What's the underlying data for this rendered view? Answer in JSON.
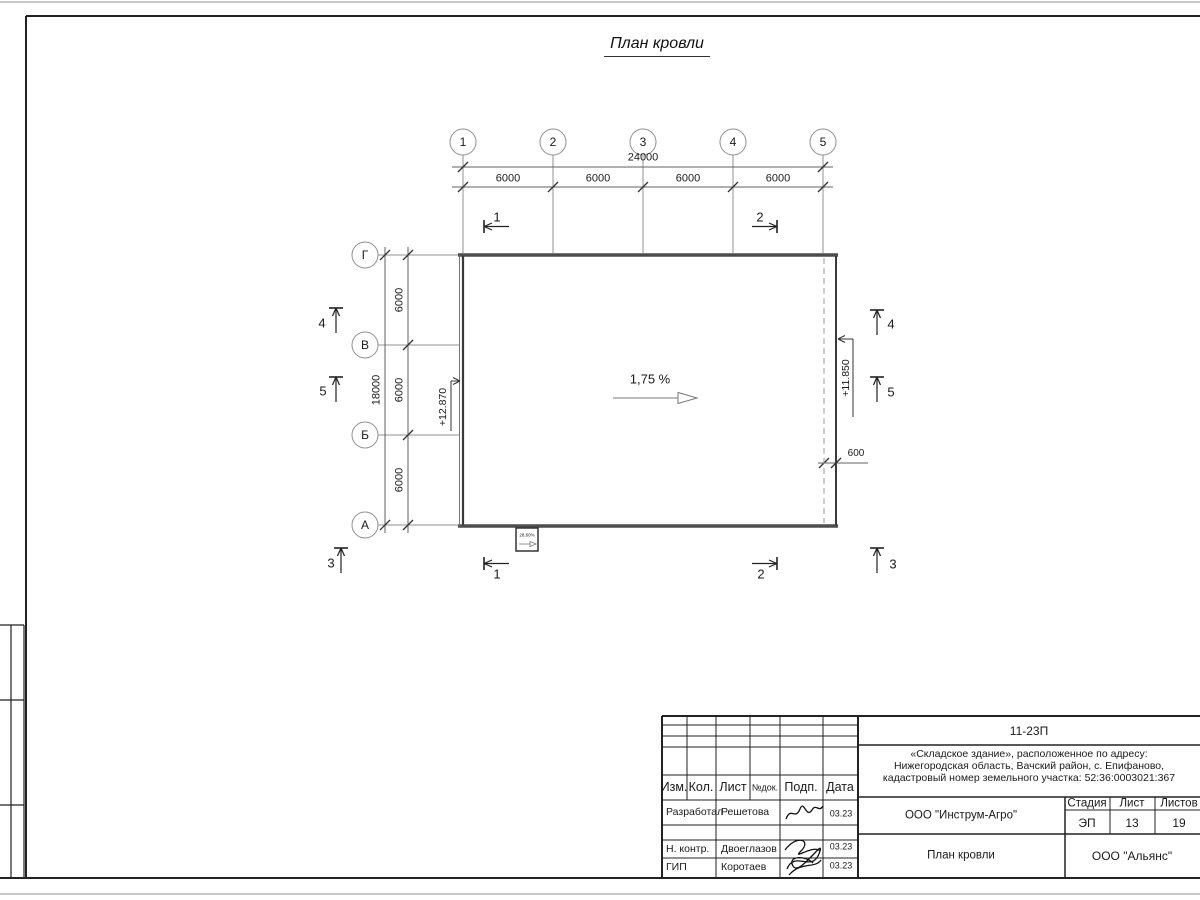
{
  "sheet": {
    "title": "План кровли"
  },
  "grid": {
    "top_axes": [
      "1",
      "2",
      "3",
      "4",
      "5"
    ],
    "left_axes": [
      "Г",
      "В",
      "Б",
      "А"
    ]
  },
  "dimensions": {
    "top_total": "24000",
    "top_segments": [
      "6000",
      "6000",
      "6000",
      "6000"
    ],
    "left_total": "18000",
    "left_segments": [
      "6000",
      "6000",
      "6000"
    ],
    "overhang": "600"
  },
  "annotations": {
    "slope": "1,75 %",
    "canopy_slope": "28,60%",
    "elevation_left": "+12.870",
    "elevation_right": "+11.850"
  },
  "section_marks": {
    "s1": "1",
    "s2": "2",
    "s3": "3",
    "s4": "4",
    "s5": "5"
  },
  "titleblock": {
    "code": "11-23П",
    "project_line1": "«Складское здание», расположенное по адресу:",
    "project_line2": "Нижегородская область, Вачский район, с. Епифаново,",
    "project_line3": "кадастровый номер земельного участка: 52:36:0003021:367",
    "columns": {
      "izm": "Изм.",
      "kol": "Кол.",
      "list": "Лист",
      "ndoc": "№док.",
      "podp": "Подп.",
      "data": "Дата"
    },
    "stage_header": {
      "stadia": "Стадия",
      "list": "Лист",
      "listov": "Листов"
    },
    "stage": "ЭП",
    "sheet_no": "13",
    "sheets_total": "19",
    "org": "ООО \"Инструм-Агро\"",
    "doc_title": "План кровли",
    "org2": "ООО \"Альянс\"",
    "rows": [
      {
        "role": "Разработал",
        "name": "Решетова",
        "date": "03.23"
      },
      {
        "role": "Н. контр.",
        "name": "Двоеглазов",
        "date": "03.23"
      },
      {
        "role": "ГИП",
        "name": "Коротаев",
        "date": "03.23"
      }
    ]
  }
}
